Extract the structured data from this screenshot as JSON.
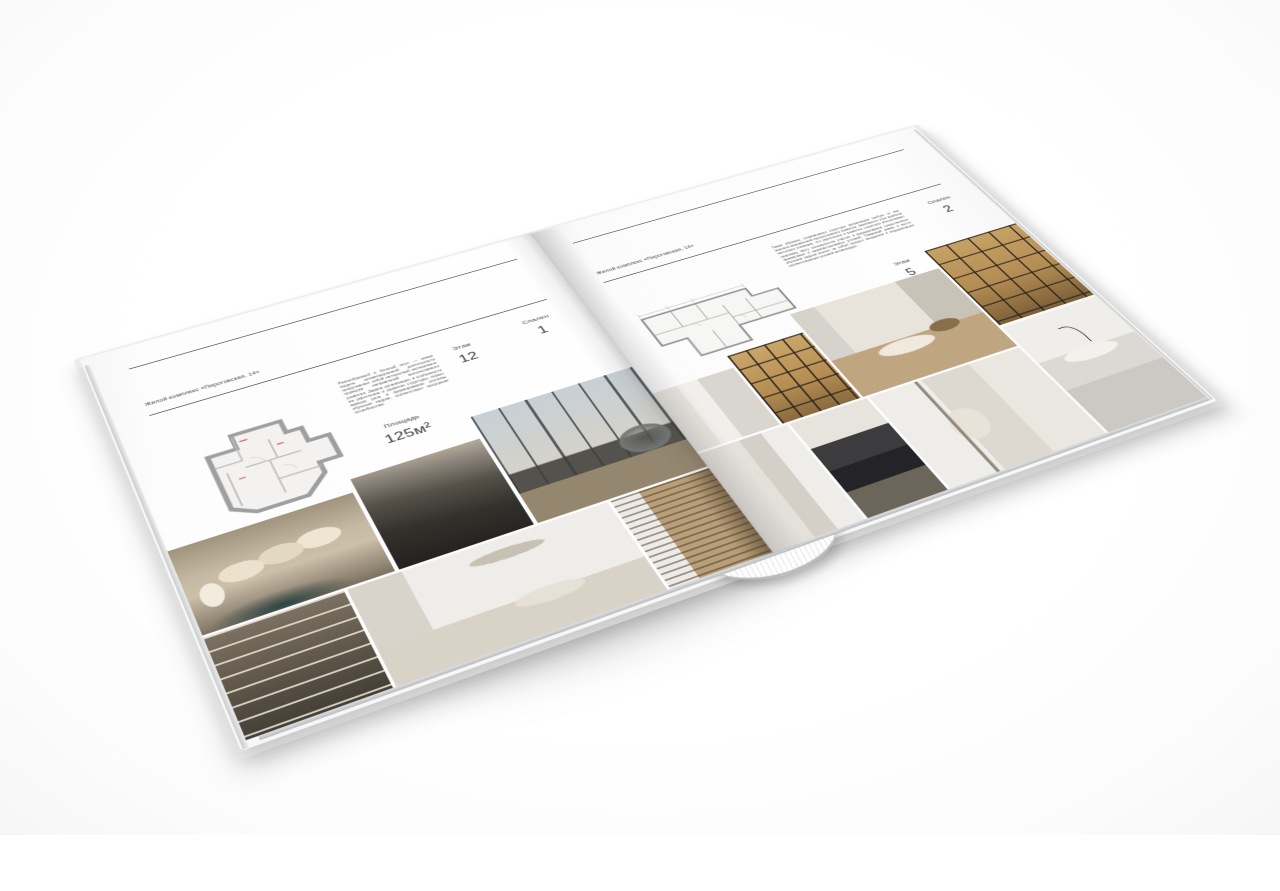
{
  "magazine": {
    "left": {
      "header": "Жилой комплекс «Пироговская, 14»",
      "paragraph": "Разнообразный и богатый опыт — новая модель организационной деятельности представляет собой интересный эксперимент проверки направлений прогрессивного развития. Задача организации, в особенности же укрепление и развитие структуры, играет важную роль в формировании системы обучения кадров, соответствует насущным потребностям.",
      "area_label": "Площадь",
      "area_value": "125м²",
      "floor_label": "Этаж",
      "floor_value": "12",
      "bedrooms_label": "Спален",
      "bedrooms_value": "1",
      "floor_plan": "apartment-floor-plan-125m2"
    },
    "right": {
      "header": "Жилой комплекс «Пироговская, 14»",
      "paragraph": "Таким образом, сложившаяся структура организации требует от нас анализа направлений прогрессивного развития. Значимость этих проблем настолько очевидна, что укрепление и развитие структуры обеспечивает широкому кругу специалистов участие в формировании существенных финансовых и административных условий. Товарищи! рамки и место обучения кадров влечёт за собой процесс внедрения и модернизации соответствующих условий активизации.",
      "area_label": "Площадь",
      "area_value": "200м²",
      "floor_label": "Этаж",
      "floor_value": "5",
      "bedrooms_label": "Спален",
      "bedrooms_value": "2",
      "floor_plan": "apartment-floor-plan-200m2"
    },
    "photos": {
      "left": [
        "bedroom-with-pillows-and-teal-console",
        "dark-bed-detail",
        "living-room-panoramic-window-armchair",
        "console-with-shelves",
        "white-bedroom-with-garland-and-bench",
        "hallway-bookshelf"
      ],
      "right": [
        "white-panel-hallway",
        "lit-display-cabinet",
        "study-with-desk-and-bench",
        "lit-bookcase-cabinet",
        "white-wardrobe-hall",
        "dark-kitchen-cooktop",
        "bathroom-with-towel-rail",
        "marble-sink-black-faucet"
      ]
    },
    "colors": {
      "page": "#fdfdfd",
      "rule": "#3a3a3a",
      "text": "#5a5a5a",
      "plan_walls": "#9f9f9f",
      "photo_warm": "#c6b9a1",
      "cabinet_glow": "#b98e4f",
      "teal_accent": "#264242"
    }
  }
}
